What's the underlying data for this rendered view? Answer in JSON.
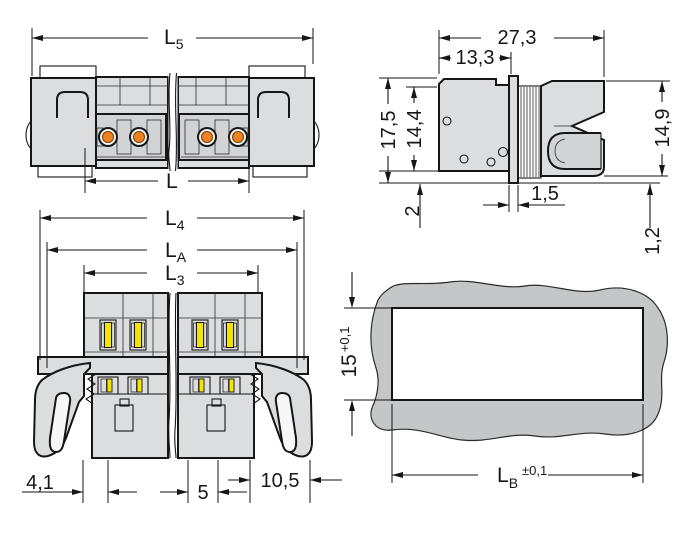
{
  "drawing_title": "connector-outline-dimension-drawing",
  "colors": {
    "body": "#dcddde",
    "body_shade": "#c9cacc",
    "ribs": "#b9babc",
    "panel": "#c5c6c8",
    "outline": "#161616",
    "orange": "#ee8220",
    "yellow": "#f2e500",
    "white": "#ffffff"
  },
  "views": {
    "top_view": {
      "dim_l5_main": "L",
      "dim_l5_sub": "5",
      "dim_l_main": "L"
    },
    "side_view": {
      "dim_width_total": "27,3",
      "dim_width_front": "13,3",
      "dim_height_flange": "17,5",
      "dim_height_body": "14,4",
      "dim_height_plug": "14,9",
      "dim_flange_protrusion": "2",
      "dim_panel_offset": "1,5",
      "dim_clearance": "1,2"
    },
    "front_view": {
      "dim_l4_main": "L",
      "dim_l4_sub": "4",
      "dim_la_main": "L",
      "dim_la_sub": "A",
      "dim_l3_main": "L",
      "dim_l3_sub": "3",
      "dim_edge_to_pole": "4,1",
      "dim_pole_pitch": "5",
      "dim_pole_to_edge": "10,5"
    },
    "cutout_view": {
      "dim_height_main": "15",
      "dim_height_tol": "+0,1",
      "dim_width_main": "L",
      "dim_width_sub": "B",
      "dim_width_tol": "±0,1"
    }
  }
}
